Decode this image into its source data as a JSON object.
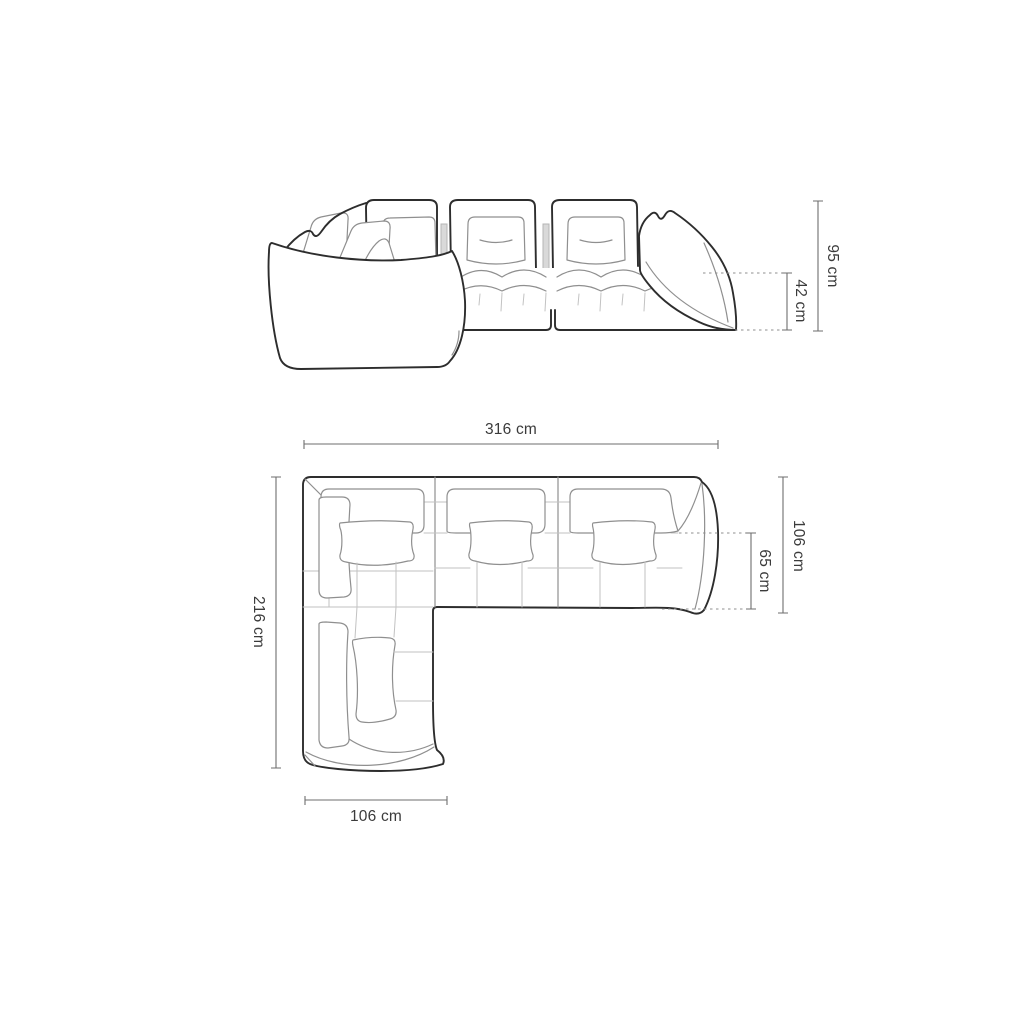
{
  "page": {
    "background": "#ffffff",
    "description": "Technical dimension drawing of a modular corner sofa: front elevation above, top plan view below"
  },
  "colors": {
    "outline": "#2d2d2d",
    "inner_line": "#8f8f8f",
    "grid_line": "#c2c2c2",
    "dimension_line": "#6e6e6e",
    "label_text": "#3b3b3b"
  },
  "diagram": {
    "subject": "corner-sectional-sofa",
    "front_view": {
      "name": "front-elevation",
      "dimensions": [
        {
          "id": "overall_height",
          "text": "95 cm",
          "orientation": "vertical"
        },
        {
          "id": "seat_height",
          "text": "42 cm",
          "orientation": "vertical"
        }
      ]
    },
    "top_view": {
      "name": "top-plan",
      "dimensions": [
        {
          "id": "overall_width",
          "text": "316 cm",
          "orientation": "horizontal"
        },
        {
          "id": "overall_depth",
          "text": "216 cm",
          "orientation": "vertical"
        },
        {
          "id": "body_depth",
          "text": "106 cm",
          "orientation": "vertical"
        },
        {
          "id": "seat_depth",
          "text": "65 cm",
          "orientation": "vertical"
        },
        {
          "id": "chaise_width",
          "text": "106 cm",
          "orientation": "horizontal"
        }
      ]
    }
  }
}
